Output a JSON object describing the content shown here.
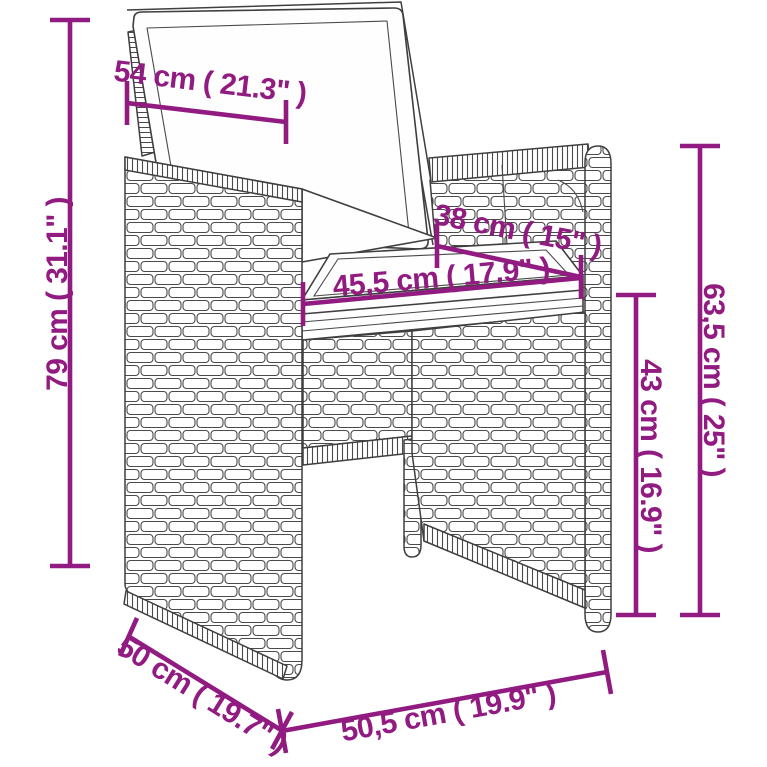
{
  "diagram": {
    "title": "rattan-armchair-dimension-diagram",
    "product": "poly rattan dining chair with cushions",
    "accent_color": "#911b81",
    "line_color": "#3f3f3f",
    "measurements": {
      "back_width": {
        "label": "54 cm ( 21.3\" )"
      },
      "total_height": {
        "label": "79 cm ( 31.1\" )"
      },
      "seat_depth": {
        "label": "38 cm ( 15\" )"
      },
      "seat_width": {
        "label": "45,5 cm ( 17.9\" )"
      },
      "back_rest_height": {
        "label": "63,5 cm ( 25\" )"
      },
      "seat_height": {
        "label": "43 cm ( 16.9\" )"
      },
      "base_depth": {
        "label": "50 cm ( 19.7\" )"
      },
      "base_width": {
        "label": "50,5 cm ( 19.9\" )"
      }
    }
  }
}
